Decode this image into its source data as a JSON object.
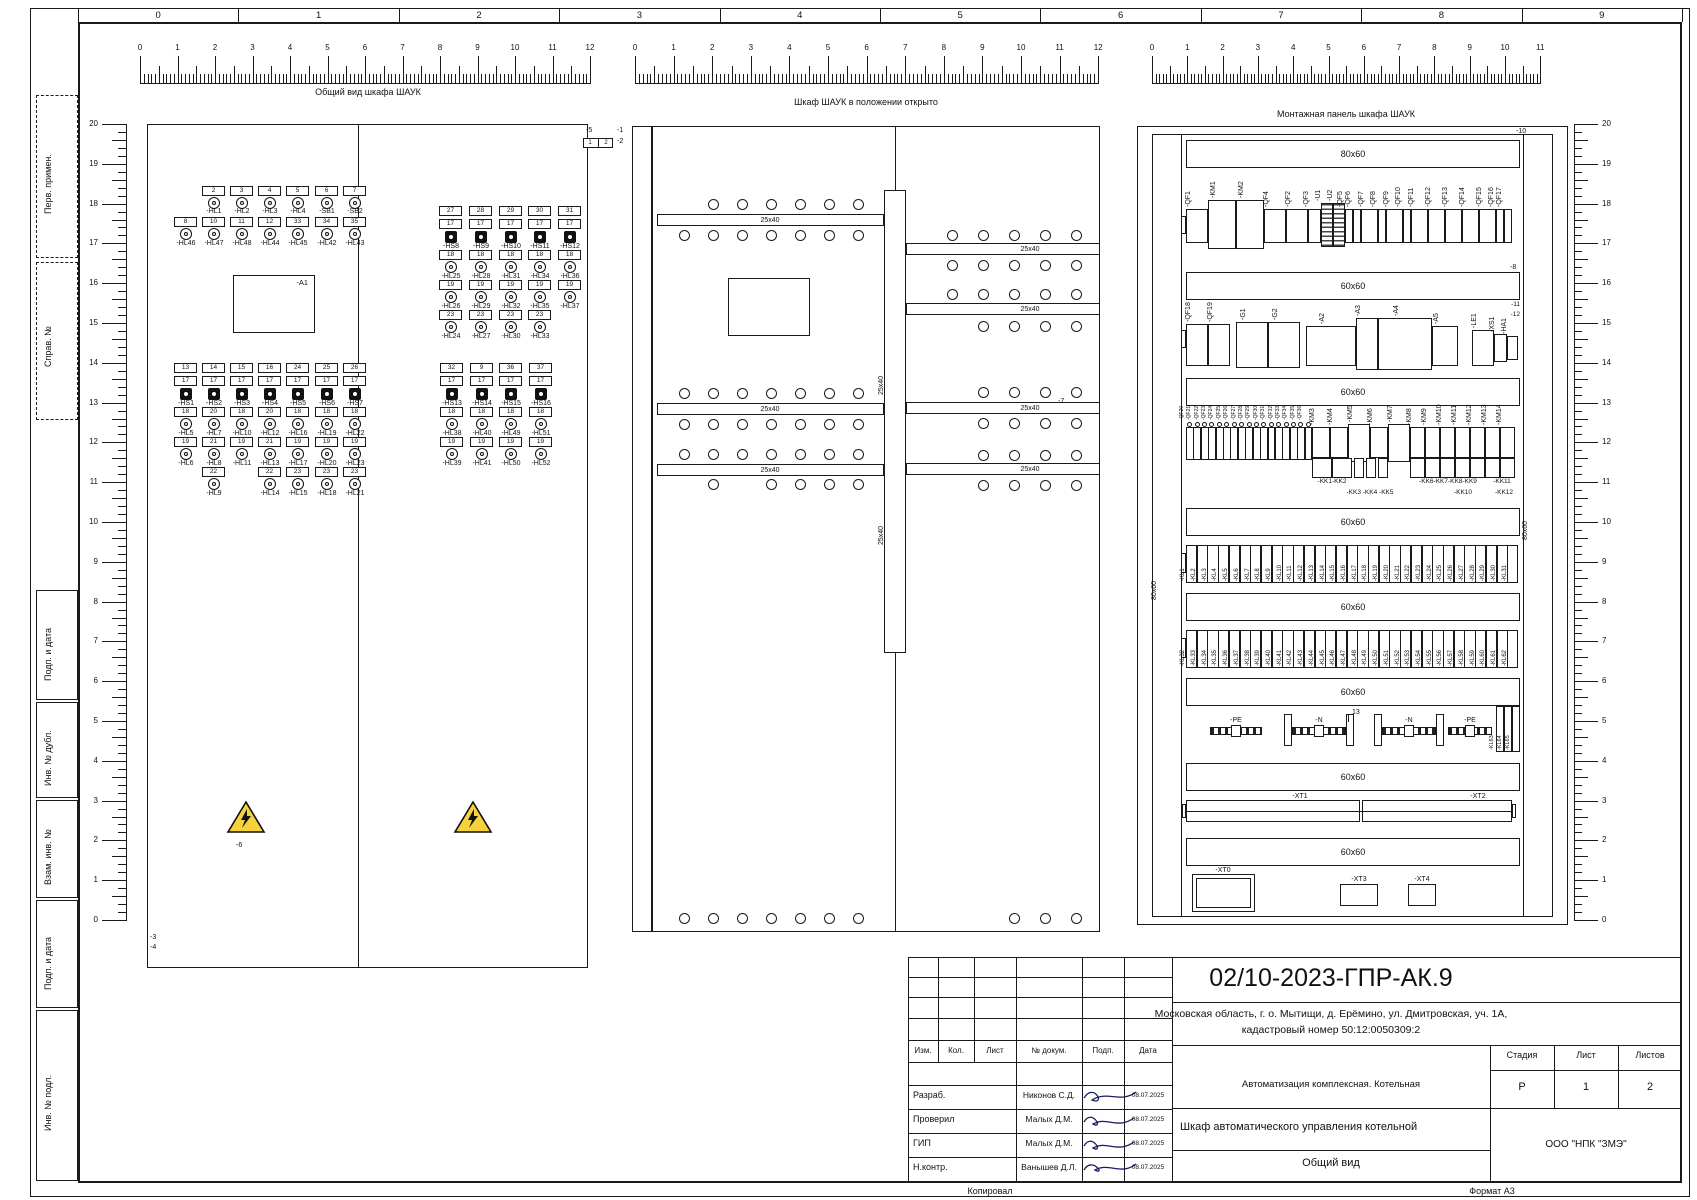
{
  "sheet": {
    "column_numbers": [
      "0",
      "1",
      "2",
      "3",
      "4",
      "5",
      "6",
      "7",
      "8",
      "9"
    ],
    "margin_labels": [
      "Перв. примен.",
      "Справ. №",
      "Подп. и дата",
      "Инв. № дубл.",
      "Взам. инв. №",
      "Подп. и дата",
      "Инв. № подл."
    ],
    "footer_left": "Копировал",
    "footer_right": "Формат  А3"
  },
  "views": {
    "front_title": "Общий вид шкафа ШАУК",
    "open_title": "Шкаф ШАУК в положении открыто",
    "plate_title": "Монтажная панель шкафа ШАУК"
  },
  "front_view": {
    "device": "-A1",
    "connector": {
      "label": "-5",
      "cells": [
        "1",
        "2"
      ]
    },
    "callouts_right": [
      "-1",
      "-2"
    ],
    "callouts_bottom": [
      "-3",
      "-4"
    ],
    "warning_callout": "-6",
    "groups": {
      "g1": {
        "rows": [
          {
            "t": "num",
            "v": [
              "",
              "2",
              "3",
              "4",
              "5",
              "6",
              "7"
            ]
          },
          {
            "t": "lamp",
            "v": [
              "",
              "1",
              "1",
              "1",
              "1",
              "1",
              "1"
            ]
          },
          {
            "t": "name",
            "v": [
              "",
              "-HL1",
              "-HL2",
              "-HL3",
              "-HL4",
              "-SB1",
              "-SB2"
            ]
          },
          {
            "t": "num",
            "v": [
              "8",
              "10",
              "11",
              "12",
              "33",
              "34",
              "35"
            ]
          },
          {
            "t": "lamp",
            "v": [
              "1",
              "1",
              "1",
              "1",
              "1",
              "1",
              "1"
            ]
          },
          {
            "t": "name",
            "v": [
              "-HL46",
              "-HL47",
              "-HL48",
              "-HL44",
              "-HL45",
              "-HL42",
              "-HL43"
            ]
          }
        ]
      },
      "g2": {
        "rows": [
          {
            "t": "num",
            "v": [
              "13",
              "14",
              "15",
              "16",
              "24",
              "25",
              "26"
            ]
          },
          {
            "t": "num",
            "v": [
              "17",
              "17",
              "17",
              "17",
              "17",
              "17",
              "17"
            ]
          },
          {
            "t": "sw",
            "v": [
              "1",
              "1",
              "1",
              "1",
              "1",
              "1",
              "1"
            ]
          },
          {
            "t": "name",
            "v": [
              "-HS1",
              "-HS2",
              "-HS3",
              "-HS4",
              "-HS5",
              "-HS6",
              "-HS7"
            ]
          },
          {
            "t": "num",
            "v": [
              "18",
              "20",
              "18",
              "20",
              "18",
              "18",
              "18"
            ]
          },
          {
            "t": "lamp",
            "v": [
              "1",
              "1",
              "1",
              "1",
              "1",
              "1",
              "1"
            ]
          },
          {
            "t": "name",
            "v": [
              "-HL5",
              "-HL7",
              "-HL10",
              "-HL12",
              "-HL16",
              "-HL19",
              "-HL22"
            ]
          },
          {
            "t": "num",
            "v": [
              "19",
              "21",
              "19",
              "21",
              "19",
              "19",
              "19"
            ]
          },
          {
            "t": "lamp",
            "v": [
              "1",
              "1",
              "1",
              "1",
              "1",
              "1",
              "1"
            ]
          },
          {
            "t": "name",
            "v": [
              "-HL6",
              "-HL8",
              "-HL11",
              "-HL13",
              "-HL17",
              "-HL20",
              "-HL23"
            ]
          },
          {
            "t": "num",
            "v": [
              "",
              "22",
              "",
              "22",
              "23",
              "23",
              "23"
            ]
          },
          {
            "t": "lamp",
            "v": [
              "",
              "1",
              "",
              "1",
              "1",
              "1",
              "1"
            ]
          },
          {
            "t": "name",
            "v": [
              "",
              "-HL9",
              "",
              "-HL14",
              "-HL15",
              "-HL18",
              "-HL21"
            ]
          }
        ]
      },
      "g3": {
        "rows": [
          {
            "t": "num",
            "v": [
              "27",
              "28",
              "29",
              "30",
              "31"
            ]
          },
          {
            "t": "num",
            "v": [
              "17",
              "17",
              "17",
              "17",
              "17"
            ]
          },
          {
            "t": "sw",
            "v": [
              "1",
              "1",
              "1",
              "1",
              "1"
            ]
          },
          {
            "t": "name",
            "v": [
              "-HS8",
              "-HS9",
              "-HS10",
              "-HS11",
              "-HS12"
            ]
          },
          {
            "t": "num",
            "v": [
              "18",
              "18",
              "18",
              "18",
              "18"
            ]
          },
          {
            "t": "lamp",
            "v": [
              "1",
              "1",
              "1",
              "1",
              "1"
            ]
          },
          {
            "t": "name",
            "v": [
              "-HL25",
              "-HL28",
              "-HL31",
              "-HL34",
              "-HL36"
            ]
          },
          {
            "t": "num",
            "v": [
              "19",
              "19",
              "19",
              "19",
              "19"
            ]
          },
          {
            "t": "lamp",
            "v": [
              "1",
              "1",
              "1",
              "1",
              "1"
            ]
          },
          {
            "t": "name",
            "v": [
              "-HL26",
              "-HL29",
              "-HL32",
              "-HL35",
              "-HL37"
            ]
          },
          {
            "t": "num",
            "v": [
              "23",
              "23",
              "23",
              "23",
              ""
            ]
          },
          {
            "t": "lamp",
            "v": [
              "1",
              "1",
              "1",
              "1",
              ""
            ]
          },
          {
            "t": "name",
            "v": [
              "-HL24",
              "-HL27",
              "-HL30",
              "-HL33",
              ""
            ]
          }
        ]
      },
      "g4": {
        "rows": [
          {
            "t": "num",
            "v": [
              "32",
              "9",
              "36",
              "37"
            ]
          },
          {
            "t": "num",
            "v": [
              "17",
              "17",
              "17",
              "17"
            ]
          },
          {
            "t": "sw",
            "v": [
              "1",
              "1",
              "1",
              "1"
            ]
          },
          {
            "t": "name",
            "v": [
              "-HS13",
              "-HS14",
              "-HS15",
              "-HS16"
            ]
          },
          {
            "t": "num",
            "v": [
              "18",
              "18",
              "18",
              "18"
            ]
          },
          {
            "t": "lamp",
            "v": [
              "1",
              "1",
              "1",
              "1"
            ]
          },
          {
            "t": "name",
            "v": [
              "-HL38",
              "-HL40",
              "-HL49",
              "-HL51"
            ]
          },
          {
            "t": "num",
            "v": [
              "19",
              "19",
              "19",
              "19"
            ]
          },
          {
            "t": "lamp",
            "v": [
              "1",
              "1",
              "1",
              "1"
            ]
          },
          {
            "t": "name",
            "v": [
              "-HL39",
              "-HL41",
              "-HL50",
              "-HL52"
            ]
          }
        ]
      }
    }
  },
  "open_view": {
    "duct_label": "25x40",
    "callout": "-7"
  },
  "plate_view": {
    "callout_top": "-10",
    "callout_duct2": "-8",
    "callout_pair": [
      "-11",
      "-12"
    ],
    "vertical_duct_label": "80x60",
    "duct1_label": "80x60",
    "duct_label": "60x60",
    "row1": [
      "-QF1",
      "-KM1",
      "-KM2",
      "-QF4",
      "-QF2",
      "-QF3",
      "-U1",
      "-U2",
      "-QF5",
      "-QF6",
      "-QF7",
      "-QF8",
      "-QF9",
      "-QF10",
      "-QF11",
      "-QF12",
      "-QF13",
      "-QF14",
      "-QF15",
      "-QF16",
      "-QF17"
    ],
    "row2": [
      "-QF18",
      "-QF19",
      "-G1",
      "-G2",
      "-A2",
      "-A3",
      "-A4",
      "-A5",
      "-LE1",
      "-XS1",
      "-HA1"
    ],
    "row3_breakers": [
      "-QF20",
      "-QF21",
      "-QF22",
      "-QF23",
      "-QF24",
      "-QF25",
      "-QF26",
      "-QF27",
      "-QF28",
      "-QF29",
      "-QF30",
      "-QF31",
      "-QF32",
      "-QF33",
      "-QF34",
      "-QF35",
      "-QF36"
    ],
    "row3_contactors": [
      "-KM3",
      "-KM4",
      "-KM5",
      "-KM6",
      "-KM7",
      "-KM8",
      "-KM9",
      "-KM10",
      "-KM11",
      "-KM12",
      "-KM13",
      "-KM14"
    ],
    "kk_labels_row1": [
      "-KK1-KK2",
      "-KK6-KK7-KK8-KK9",
      "-KK11"
    ],
    "kk_labels_row2": [
      "-KK3",
      "-KK4",
      "-KK5",
      "-KK10",
      "-KK12"
    ],
    "kl_row1": [
      "-KL1",
      "-KL2",
      "-KL3",
      "-KL4",
      "-KL5",
      "-KL6",
      "-KL7",
      "-KL8",
      "-KL9",
      "-KL10",
      "-KL11",
      "-KL12",
      "-KL13",
      "-KL14",
      "-KL15",
      "-KL16",
      "-KL17",
      "-KL18",
      "-KL19",
      "-KL20",
      "-KL21",
      "-KL22",
      "-KL23",
      "-KL24",
      "-KL25",
      "-KL26",
      "-KL27",
      "-KL28",
      "-KL29",
      "-KL30",
      "-KL31"
    ],
    "kl_row2": [
      "-KL32",
      "-KL33",
      "-KL34",
      "-KL35",
      "-KL36",
      "-KL37",
      "-KL38",
      "-KL39",
      "-KL40",
      "-KL41",
      "-KL42",
      "-KL43",
      "-KL44",
      "-KL45",
      "-KL46",
      "-KL47",
      "-KL48",
      "-KL49",
      "-KL50",
      "-KL51",
      "-KL52",
      "-KL53",
      "-KL54",
      "-KL55",
      "-KL56",
      "-KL57",
      "-KL58",
      "-KL59",
      "-KL60",
      "-KL61",
      "-KL62"
    ],
    "kl_row3": [
      "-KL63",
      "-KL64",
      "-KL65"
    ],
    "busbars": [
      "-PE",
      "-N",
      "-N",
      "-PE"
    ],
    "busbar_callout": "13",
    "xt_labels": [
      "-XT1",
      "-XT2"
    ],
    "xt_bottom": [
      "-XT0",
      "-XT3",
      "-XT4"
    ]
  },
  "title_block": {
    "doc_number": "02/10-2023-ГПР-АК.9",
    "address_line1": "Московская область, г. о. Мытищи, д. Ерёмино, ул. Дмитровская, уч. 1А,",
    "address_line2": "кадастровый номер 50:12:0050309:2",
    "rev_headers": [
      "Изм.",
      "Кол.",
      "Лист",
      "№ докум.",
      "Подп.",
      "Дата"
    ],
    "project_type": "Автоматизация комплексная. Котельная",
    "object_name": "Шкаф автоматического управления котельной",
    "drawing_name": "Общий вид",
    "company": "ООО \"НПК \"ЗМЭ\"",
    "stage_headers": [
      "Стадия",
      "Лист",
      "Листов"
    ],
    "stage_values": [
      "Р",
      "1",
      "2"
    ],
    "staff": [
      {
        "role": "Разраб.",
        "name": "Никонов С.Д.",
        "date": "08.07.2025"
      },
      {
        "role": "Проверил",
        "name": "Малых Д.М.",
        "date": "08.07.2025"
      },
      {
        "role": "ГИП",
        "name": "Малых Д.М.",
        "date": "08.07.2025"
      },
      {
        "role": "Н.контр.",
        "name": "Ванышев Д.Л.",
        "date": "08.07.2025"
      }
    ]
  }
}
